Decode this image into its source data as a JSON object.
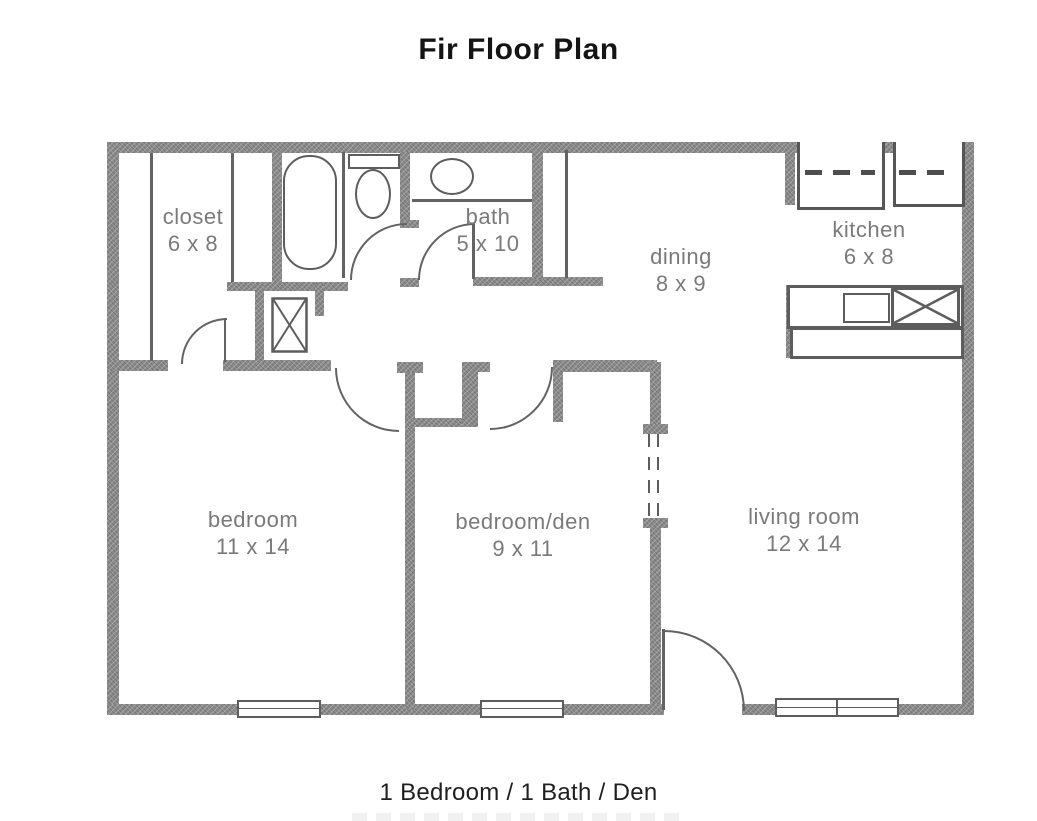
{
  "title": "Fir Floor Plan",
  "caption": "1 Bedroom / 1 Bath / Den",
  "rooms": [
    {
      "name": "closet",
      "dims": "6 x 8"
    },
    {
      "name": "bath",
      "dims": "5 x 10"
    },
    {
      "name": "dining",
      "dims": "8 x 9"
    },
    {
      "name": "kitchen",
      "dims": "6 x 8"
    },
    {
      "name": "bedroom",
      "dims": "11 x 14"
    },
    {
      "name": "bedroom/den",
      "dims": "9 x 11"
    },
    {
      "name": "living room",
      "dims": "12 x 14"
    }
  ],
  "fixtures": [
    "bathtub",
    "toilet",
    "bathroom-sink",
    "washer-closet-x-box",
    "upper-cabinets-dashed",
    "range",
    "kitchen-sink-x-box",
    "window",
    "door-swing",
    "bifold-door-opening",
    "entry-door"
  ],
  "colors": {
    "wall": "#8c8c8c",
    "line": "#636363",
    "room_label": "#7a7a7a",
    "title": "#141414",
    "caption": "#1f1f1f",
    "background": "#ffffff"
  }
}
